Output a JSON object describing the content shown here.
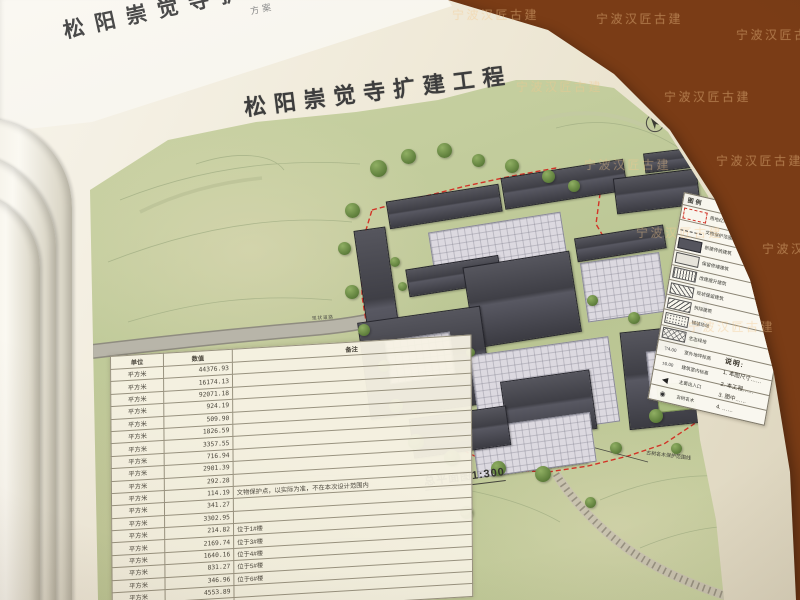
{
  "watermark": {
    "text": "宁波汉匠古建"
  },
  "previous_page": {
    "partial_title": "松阳崇觉寺扩建工程",
    "corner_text": "方案"
  },
  "page": {
    "title": "松阳崇觉寺扩建工程",
    "plan_caption": "总平面图1:300"
  },
  "map": {
    "road_label": "现状道路",
    "ancient_tree_label": "古树名木保护范围线"
  },
  "area_table": {
    "headers": [
      "单位",
      "数值",
      "备注"
    ],
    "rows": [
      [
        "平方米",
        "44376.93",
        ""
      ],
      [
        "平方米",
        "16174.13",
        ""
      ],
      [
        "平方米",
        "92071.18",
        ""
      ],
      [
        "平方米",
        "924.19",
        ""
      ],
      [
        "平方米",
        "509.90",
        ""
      ],
      [
        "平方米",
        "1826.59",
        ""
      ],
      [
        "平方米",
        "3357.55",
        ""
      ],
      [
        "平方米",
        "716.94",
        ""
      ],
      [
        "平方米",
        "2901.39",
        ""
      ],
      [
        "平方米",
        "292.28",
        ""
      ],
      [
        "平方米",
        "114.19",
        "文物保护点，以实际为准，不在本次设计范围内"
      ],
      [
        "平方米",
        "341.27",
        ""
      ],
      [
        "平方米",
        "3302.95",
        ""
      ],
      [
        "平方米",
        "214.82",
        "位于1#楼"
      ],
      [
        "平方米",
        "2169.74",
        "位于3#楼"
      ],
      [
        "平方米",
        "1640.16",
        "位于4#楼"
      ],
      [
        "平方米",
        "831.27",
        "位于5#楼"
      ],
      [
        "平方米",
        "346.96",
        "位于6#楼"
      ],
      [
        "平方米",
        "4553.89",
        ""
      ],
      [
        "平方米",
        "65.96",
        "……"
      ]
    ]
  },
  "legend": {
    "title": "图例",
    "items": [
      {
        "symbol": "red-dash-box",
        "label": "用地红线"
      },
      {
        "symbol": "dash-line",
        "label": "文物保护范围线"
      },
      {
        "symbol": "solid-box",
        "label": "新建传统建筑"
      },
      {
        "symbol": "light-box",
        "label": "保留修缮建筑"
      },
      {
        "symbol": "vhatch-box",
        "label": "改建提升建筑"
      },
      {
        "symbol": "hatch-box",
        "label": "现状保留建筑"
      },
      {
        "symbol": "hatch2-box",
        "label": "拆除建筑"
      },
      {
        "symbol": "dot-box",
        "label": "铺装场地"
      },
      {
        "symbol": "cross-box",
        "label": "生态绿地"
      },
      {
        "symbol": "elev-marker",
        "label": "室外地坪标高",
        "value": "▽4.00"
      },
      {
        "symbol": "elev2-marker",
        "label": "建筑室内标高",
        "value": "±0.00"
      },
      {
        "symbol": "entry-arrow",
        "label": "主要出入口",
        "value": "◀"
      },
      {
        "symbol": "tree-mark",
        "label": "古树名木",
        "value": "◉"
      }
    ]
  },
  "notes": {
    "title": "说明:",
    "items": [
      "1. 本图尺寸……",
      "2. 本工程……",
      "3. 图中……",
      "4. ……"
    ]
  }
}
